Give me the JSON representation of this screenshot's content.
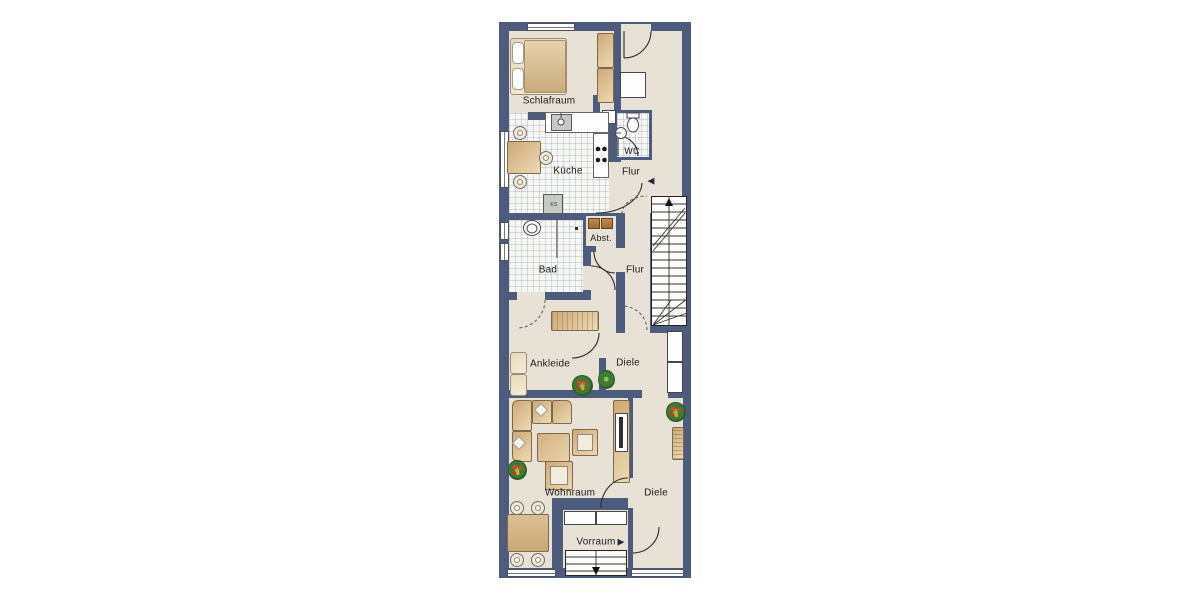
{
  "plan_title": "Wohnung Grundriss",
  "labels": {
    "schlafraum": "Schlafraum",
    "kueche": "Küche",
    "wc": "WC",
    "flur_top": "Flur",
    "abst": "Abst.",
    "bad": "Bad",
    "flur_mid": "Flur",
    "ankleide": "Ankleide",
    "diele_mid": "Diele",
    "wohnraum": "Wohnraum",
    "diele_lower": "Diele",
    "vorraum": "Vorraum",
    "ks": "KS"
  },
  "icons": {
    "entrance_arrow": "▶",
    "stairs_arrow": "◀"
  },
  "colors": {
    "wall": "#4d5c7c",
    "floor": "#e7e1d6",
    "tile_floor": "#f7f7f4",
    "furniture": "#d9b98a",
    "fixture_white": "#ffffff",
    "plant_green": "#3d7a33",
    "plant_red": "#d8452a",
    "stairs": "#fdfdfb",
    "line": "#2b2b2b"
  }
}
